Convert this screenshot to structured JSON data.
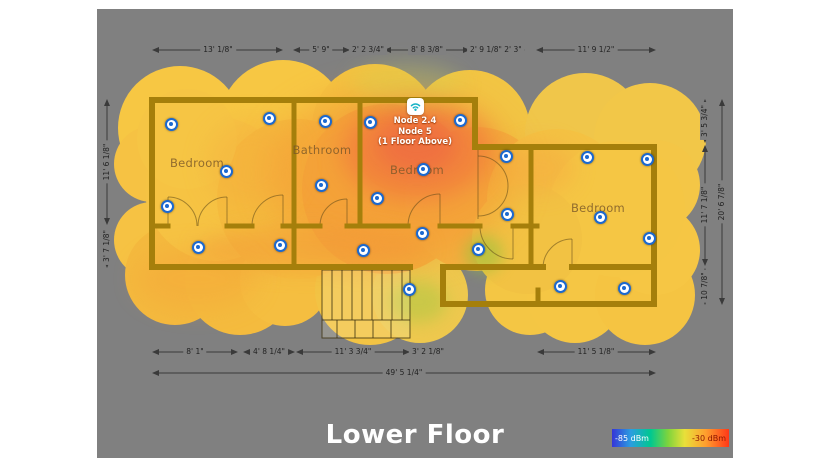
{
  "title": "Lower Floor",
  "node": {
    "icon": "wifi-icon",
    "labels": [
      "Node 2.4",
      "Node 5",
      "(1 Floor Above)"
    ]
  },
  "rooms": [
    "Bedroom",
    "Bathroom",
    "Bedroom",
    "Bedroom"
  ],
  "dimensions": {
    "top": [
      "13' 1/8\"",
      "5' 9\"",
      "2' 2 3/4\"",
      "8' 8 3/8\"",
      "2' 9 1/8\"",
      "2' 3\"",
      "11' 9 1/2\""
    ],
    "bottom": [
      "8' 1\"",
      "4' 8 1/4\"",
      "11' 3 3/4\"",
      "3' 2 1/8\"",
      "11' 5 1/8\""
    ],
    "bottom_total": "49' 5 1/4\"",
    "left": [
      "11' 6 1/8\"",
      "3' 7 1/8\""
    ],
    "right": [
      "3' 5 3/4\"",
      "11' 7 1/8\"",
      "10 7/8\""
    ],
    "right_total": "20' 6 7/8\""
  },
  "legend": {
    "min_label": "-85 dBm",
    "max_label": "-30 dBm",
    "gradient": [
      "#3535d8",
      "#2b9de0",
      "#00c890",
      "#7fd43c",
      "#e8e03a",
      "#ff9f2e",
      "#ff3818"
    ],
    "min_label_color": "#ffffff",
    "max_label_color": "#8d1500"
  },
  "measurement_points": [
    {
      "x": 74,
      "y": 115
    },
    {
      "x": 172,
      "y": 109
    },
    {
      "x": 228,
      "y": 112
    },
    {
      "x": 273,
      "y": 113
    },
    {
      "x": 363,
      "y": 111
    },
    {
      "x": 129,
      "y": 162
    },
    {
      "x": 70,
      "y": 197
    },
    {
      "x": 224,
      "y": 176
    },
    {
      "x": 280,
      "y": 189
    },
    {
      "x": 326,
      "y": 160
    },
    {
      "x": 409,
      "y": 147
    },
    {
      "x": 490,
      "y": 148
    },
    {
      "x": 550,
      "y": 150
    },
    {
      "x": 410,
      "y": 205
    },
    {
      "x": 503,
      "y": 208
    },
    {
      "x": 552,
      "y": 229
    },
    {
      "x": 101,
      "y": 238
    },
    {
      "x": 183,
      "y": 236
    },
    {
      "x": 266,
      "y": 241
    },
    {
      "x": 325,
      "y": 224
    },
    {
      "x": 381,
      "y": 240
    },
    {
      "x": 312,
      "y": 280
    },
    {
      "x": 463,
      "y": 277
    },
    {
      "x": 527,
      "y": 279
    }
  ],
  "colors": {
    "canvas_background": "#808080",
    "page_background": "#ffffff",
    "wall": "#a57f0b",
    "heat_base": "#f6c544",
    "heat_hot": "#ec5a48",
    "heat_cool": "#a8c842",
    "point_blue": "#1b69d0",
    "title_color": "#ffffff"
  }
}
